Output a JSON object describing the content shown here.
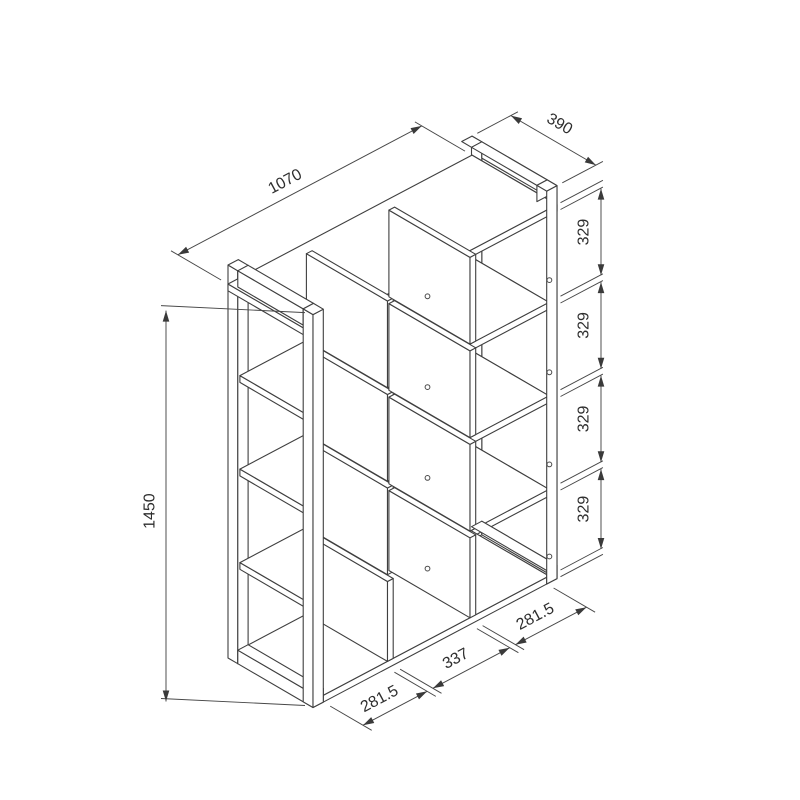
{
  "page": {
    "background": "#ffffff"
  },
  "drawing": {
    "title": "Isometric dimension drawing of open cube shelving unit",
    "type": "technical-line-drawing",
    "line_color": "#3f3f3f",
    "dimension_line_color": "#474747",
    "text_color": "#2e2e2e",
    "dimensions": {
      "width": {
        "label": "1070",
        "value": 1070
      },
      "depth": {
        "label": "390",
        "value": 390
      },
      "height": {
        "label": "1450",
        "value": 1450
      },
      "row_heights": [
        {
          "label": "329",
          "value": 329
        },
        {
          "label": "329",
          "value": 329
        },
        {
          "label": "329",
          "value": 329
        },
        {
          "label": "329",
          "value": 329
        }
      ],
      "column_widths": [
        {
          "label": "281.5",
          "value": 281.5
        },
        {
          "label": "337",
          "value": 337
        },
        {
          "label": "281.5",
          "value": 281.5
        }
      ]
    },
    "structure": {
      "rows": 4,
      "columns": 3,
      "posts": 4,
      "shelves": 5,
      "dividers": 2
    }
  }
}
